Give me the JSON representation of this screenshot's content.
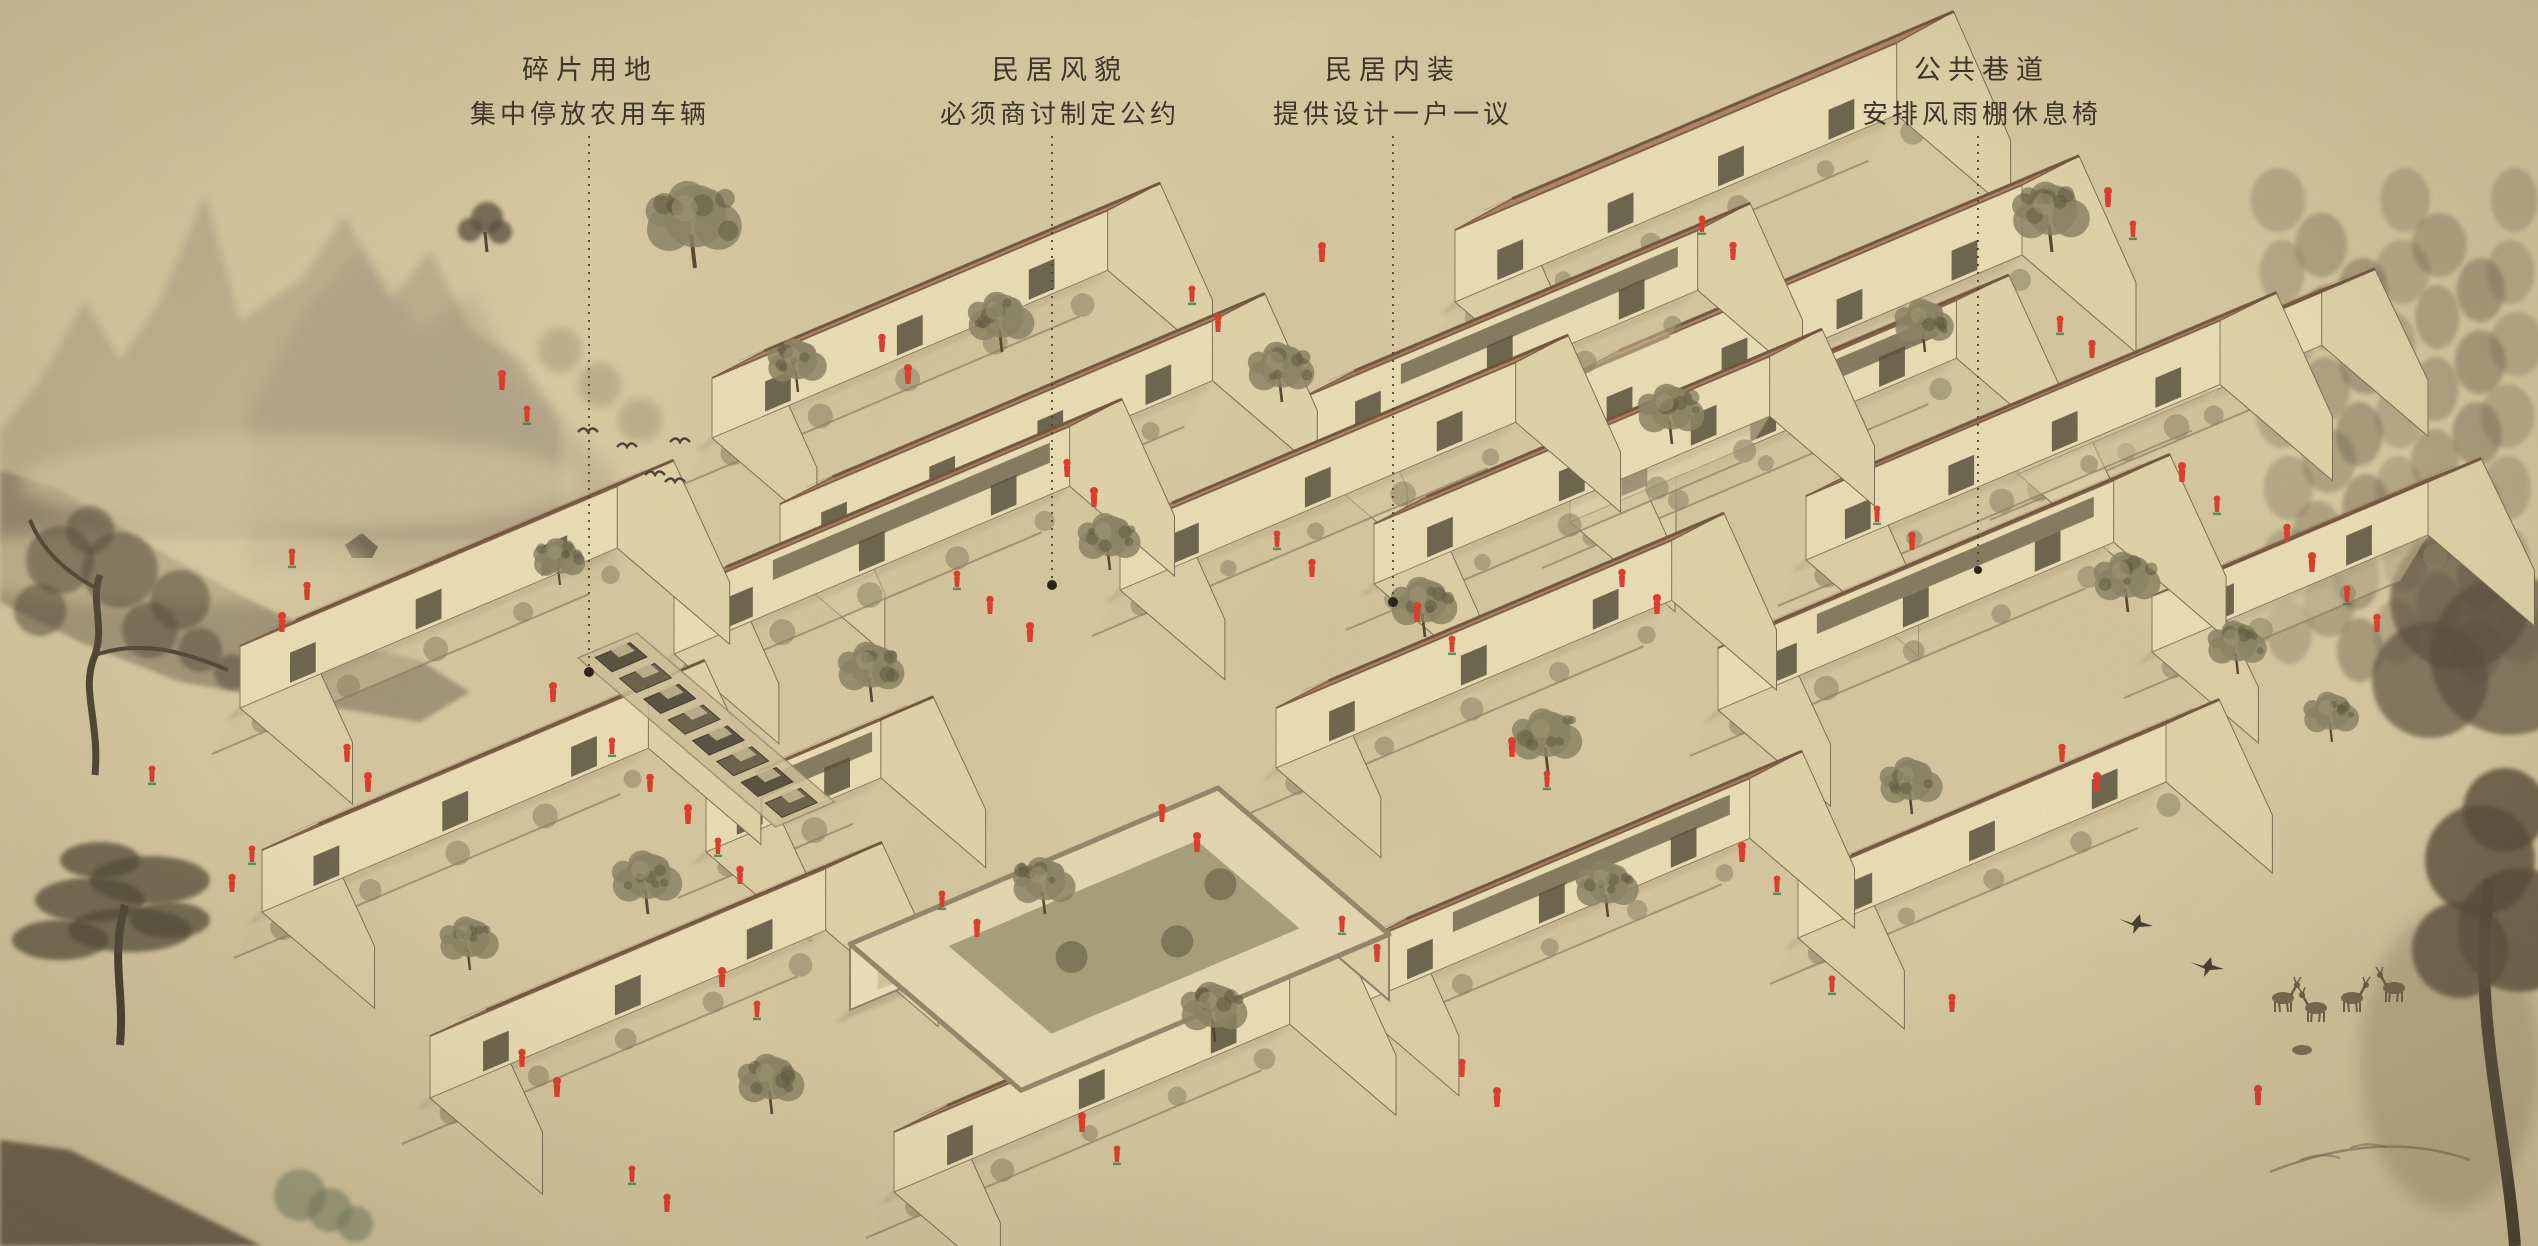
{
  "palette": {
    "paper": "#d9cca3",
    "ink": "#4a4136",
    "text": "#3e362a",
    "roof_tones": [
      "#bd9271",
      "#c59a79",
      "#b3886a"
    ],
    "roof_line": "#8d684c",
    "ridge": "#6e523a",
    "wall": "#ebdfb6",
    "wall_shade": "#ddd0a6",
    "wall_dark": "#564d3a",
    "foliage": "#8a8263",
    "foliage_dark": "#615a40",
    "figure_red": "#df392c",
    "figure_green": "#3e7a49",
    "leader": "#463c2e",
    "mountain": "#8c8070",
    "mountain_front": "#6e6251",
    "pine": "#6d6250",
    "tree_ink": "#554c3b",
    "deer": "#6b5b44"
  },
  "annotations": [
    {
      "id": "fragment-land",
      "title": "碎片用地",
      "subtitle": "集中停放农用车辆",
      "x": 590,
      "text_top": 48,
      "leader": {
        "x": 589,
        "y1": 136,
        "y2": 672,
        "dot_r": 5
      }
    },
    {
      "id": "dwelling-style",
      "title": "民居风貌",
      "subtitle": "必须商讨制定公约",
      "x": 1060,
      "text_top": 48,
      "leader": {
        "x": 1052,
        "y1": 136,
        "y2": 585,
        "dot_r": 5
      }
    },
    {
      "id": "dwelling-interior",
      "title": "民居内装",
      "subtitle": "提供设计一户一议",
      "x": 1393,
      "text_top": 48,
      "leader": {
        "x": 1393,
        "y1": 136,
        "y2": 602,
        "dot_r": 5
      }
    },
    {
      "id": "public-lane",
      "title": "公共巷道",
      "subtitle": "安排风雨棚休息椅",
      "x": 1982,
      "text_top": 48,
      "leader": {
        "x": 1978,
        "y1": 136,
        "y2": 570,
        "dot_r": 4
      }
    }
  ],
  "village": {
    "houses": [
      {
        "x": 1455,
        "y": 302,
        "l": 480,
        "w": 150,
        "h": 72,
        "r": 80,
        "t": 0
      },
      {
        "x": 1562,
        "y": 450,
        "l": 500,
        "w": 150,
        "h": 70,
        "r": 78,
        "t": 1
      },
      {
        "x": 712,
        "y": 438,
        "l": 430,
        "w": 138,
        "h": 60,
        "r": 72,
        "t": 1
      },
      {
        "x": 780,
        "y": 564,
        "l": 470,
        "w": 138,
        "h": 60,
        "r": 72,
        "t": 0
      },
      {
        "x": 1302,
        "y": 458,
        "l": 430,
        "w": 138,
        "h": 60,
        "r": 72,
        "t": 2
      },
      {
        "x": 1374,
        "y": 584,
        "l": 430,
        "w": 138,
        "h": 60,
        "r": 72,
        "t": 0
      },
      {
        "x": 1806,
        "y": 560,
        "l": 450,
        "w": 148,
        "h": 64,
        "r": 76,
        "t": 1
      },
      {
        "x": 240,
        "y": 708,
        "l": 410,
        "w": 148,
        "h": 62,
        "r": 74,
        "t": 0
      },
      {
        "x": 674,
        "y": 654,
        "l": 430,
        "w": 138,
        "h": 60,
        "r": 72,
        "t": 2
      },
      {
        "x": 1120,
        "y": 590,
        "l": 430,
        "w": 138,
        "h": 60,
        "r": 72,
        "t": 1
      },
      {
        "x": 1570,
        "y": 522,
        "l": 420,
        "w": 138,
        "h": 58,
        "r": 70,
        "t": 2
      },
      {
        "x": 2018,
        "y": 474,
        "l": 330,
        "w": 140,
        "h": 56,
        "r": 66,
        "t": 0
      },
      {
        "x": 262,
        "y": 912,
        "l": 420,
        "w": 148,
        "h": 62,
        "r": 74,
        "t": 1
      },
      {
        "x": 706,
        "y": 852,
        "l": 190,
        "w": 138,
        "h": 58,
        "r": 68,
        "t": 2
      },
      {
        "x": 1276,
        "y": 768,
        "l": 430,
        "w": 138,
        "h": 60,
        "r": 72,
        "t": 0
      },
      {
        "x": 1718,
        "y": 710,
        "l": 430,
        "w": 148,
        "h": 62,
        "r": 74,
        "t": 2
      },
      {
        "x": 2152,
        "y": 652,
        "l": 300,
        "w": 140,
        "h": 56,
        "r": 66,
        "t": 1
      },
      {
        "x": 430,
        "y": 1098,
        "l": 430,
        "w": 148,
        "h": 62,
        "r": 74,
        "t": 0
      },
      {
        "x": 894,
        "y": 1192,
        "l": 430,
        "w": 140,
        "h": 60,
        "r": 72,
        "t": 1
      },
      {
        "x": 1354,
        "y": 1006,
        "l": 430,
        "w": 138,
        "h": 60,
        "r": 72,
        "t": 2
      },
      {
        "x": 1798,
        "y": 938,
        "l": 400,
        "w": 140,
        "h": 58,
        "r": 70,
        "t": 0
      }
    ],
    "flat_building": {
      "x": 850,
      "y": 1010,
      "l": 400,
      "w": 225,
      "h": 66
    },
    "parking": {
      "x": 578,
      "y": 658,
      "width_u": 64,
      "length_v": 260,
      "vehicle_count": 8
    },
    "trees": [
      [
        695,
        268,
        1.3
      ],
      [
        1002,
        352,
        0.9
      ],
      [
        798,
        392,
        0.8
      ],
      [
        1282,
        402,
        0.9
      ],
      [
        1672,
        444,
        0.9
      ],
      [
        2052,
        252,
        1.05
      ],
      [
        1925,
        352,
        0.8
      ],
      [
        1110,
        570,
        0.85
      ],
      [
        1425,
        637,
        0.9
      ],
      [
        872,
        702,
        0.9
      ],
      [
        1548,
        772,
        0.95
      ],
      [
        2128,
        612,
        0.9
      ],
      [
        648,
        914,
        0.95
      ],
      [
        1045,
        914,
        0.85
      ],
      [
        1215,
        1042,
        0.9
      ],
      [
        772,
        1114,
        0.9
      ],
      [
        470,
        970,
        0.8
      ],
      [
        1608,
        917,
        0.85
      ],
      [
        1912,
        814,
        0.85
      ],
      [
        2238,
        674,
        0.8
      ],
      [
        2332,
        742,
        0.75
      ],
      [
        560,
        585,
        0.7
      ]
    ],
    "figures": [
      [
        292,
        565
      ],
      [
        307,
        600
      ],
      [
        282,
        632
      ],
      [
        152,
        782
      ],
      [
        347,
        762
      ],
      [
        368,
        792
      ],
      [
        252,
        862
      ],
      [
        232,
        892
      ],
      [
        553,
        702
      ],
      [
        612,
        754
      ],
      [
        650,
        792
      ],
      [
        688,
        824
      ],
      [
        718,
        854
      ],
      [
        740,
        884
      ],
      [
        502,
        390
      ],
      [
        527,
        422
      ],
      [
        882,
        352
      ],
      [
        908,
        384
      ],
      [
        1192,
        302
      ],
      [
        1218,
        332
      ],
      [
        1322,
        262
      ],
      [
        1702,
        232
      ],
      [
        1733,
        260
      ],
      [
        2108,
        207
      ],
      [
        2133,
        237
      ],
      [
        1067,
        477
      ],
      [
        1094,
        507
      ],
      [
        957,
        587
      ],
      [
        990,
        614
      ],
      [
        1030,
        642
      ],
      [
        1277,
        547
      ],
      [
        1312,
        577
      ],
      [
        1417,
        622
      ],
      [
        1452,
        652
      ],
      [
        1622,
        587
      ],
      [
        1657,
        614
      ],
      [
        1877,
        522
      ],
      [
        1912,
        550
      ],
      [
        2182,
        482
      ],
      [
        2217,
        512
      ],
      [
        2287,
        542
      ],
      [
        2312,
        572
      ],
      [
        2347,
        602
      ],
      [
        2377,
        632
      ],
      [
        1512,
        757
      ],
      [
        1547,
        787
      ],
      [
        1162,
        822
      ],
      [
        1197,
        852
      ],
      [
        942,
        907
      ],
      [
        977,
        937
      ],
      [
        722,
        987
      ],
      [
        757,
        1017
      ],
      [
        522,
        1067
      ],
      [
        557,
        1097
      ],
      [
        1342,
        932
      ],
      [
        1377,
        962
      ],
      [
        1742,
        862
      ],
      [
        1777,
        892
      ],
      [
        2062,
        762
      ],
      [
        2097,
        792
      ],
      [
        632,
        1182
      ],
      [
        667,
        1212
      ],
      [
        1082,
        1132
      ],
      [
        1117,
        1162
      ],
      [
        1462,
        1077
      ],
      [
        1497,
        1107
      ],
      [
        1832,
        992
      ],
      [
        1952,
        1012
      ],
      [
        2258,
        1105
      ],
      [
        2060,
        332
      ],
      [
        2092,
        358
      ]
    ]
  },
  "background": {
    "birds_flock": [
      [
        588,
        432
      ],
      [
        627,
        447
      ],
      [
        680,
        442
      ],
      [
        655,
        475
      ],
      [
        675,
        482
      ]
    ],
    "swallows": [
      [
        2137,
        925
      ],
      [
        2208,
        968
      ]
    ],
    "deer": [
      [
        2283,
        1010,
        0
      ],
      [
        2316,
        1020,
        1
      ],
      [
        2352,
        1010,
        0
      ],
      [
        2394,
        1000,
        1
      ]
    ],
    "fawn": [
      2302,
      1050
    ]
  }
}
